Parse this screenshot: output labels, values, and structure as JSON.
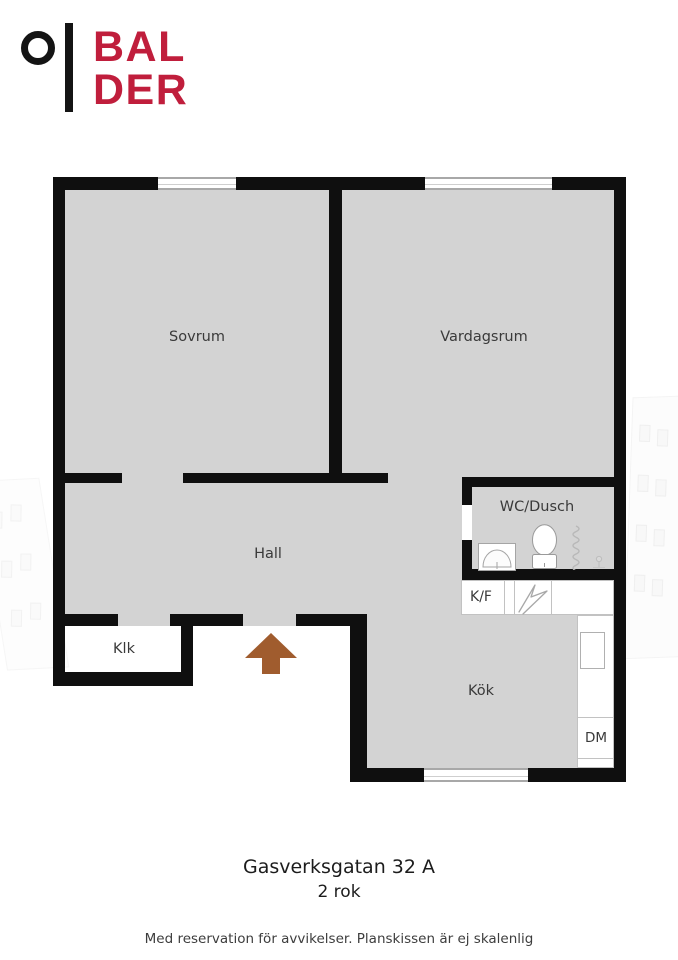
{
  "brand": {
    "word1": "BAL",
    "word2": "DER",
    "color_red": "#c01e3c",
    "color_black": "#141414"
  },
  "floorplan": {
    "rooms": {
      "sovrum": {
        "label": "Sovrum"
      },
      "vardagsrum": {
        "label": "Vardagsrum"
      },
      "hall": {
        "label": "Hall"
      },
      "wc_dusch": {
        "label": "WC/Dusch"
      },
      "klk": {
        "label": "Klk"
      },
      "kok": {
        "label": "Kök"
      },
      "kf": {
        "label": "K/F"
      },
      "dm": {
        "label": "DM"
      }
    },
    "icons": [
      "entrance-arrow-icon",
      "toilet-icon",
      "bathroom-sink-icon",
      "shower-curtain-icon",
      "floor-drain-icon",
      "stove-icon",
      "kitchen-sink-icon"
    ],
    "colors": {
      "wall": "#0f0f0f",
      "room_fill": "#d3d3d3",
      "entrance_arrow": "#a05c2e",
      "fixture_outline": "#9a9a9a"
    }
  },
  "caption": {
    "address": "Gasverksgatan 32 A",
    "size": "2 rok"
  },
  "footer": {
    "disclaimer": "Med reservation för avvikelser. Planskissen är ej skalenlig"
  }
}
